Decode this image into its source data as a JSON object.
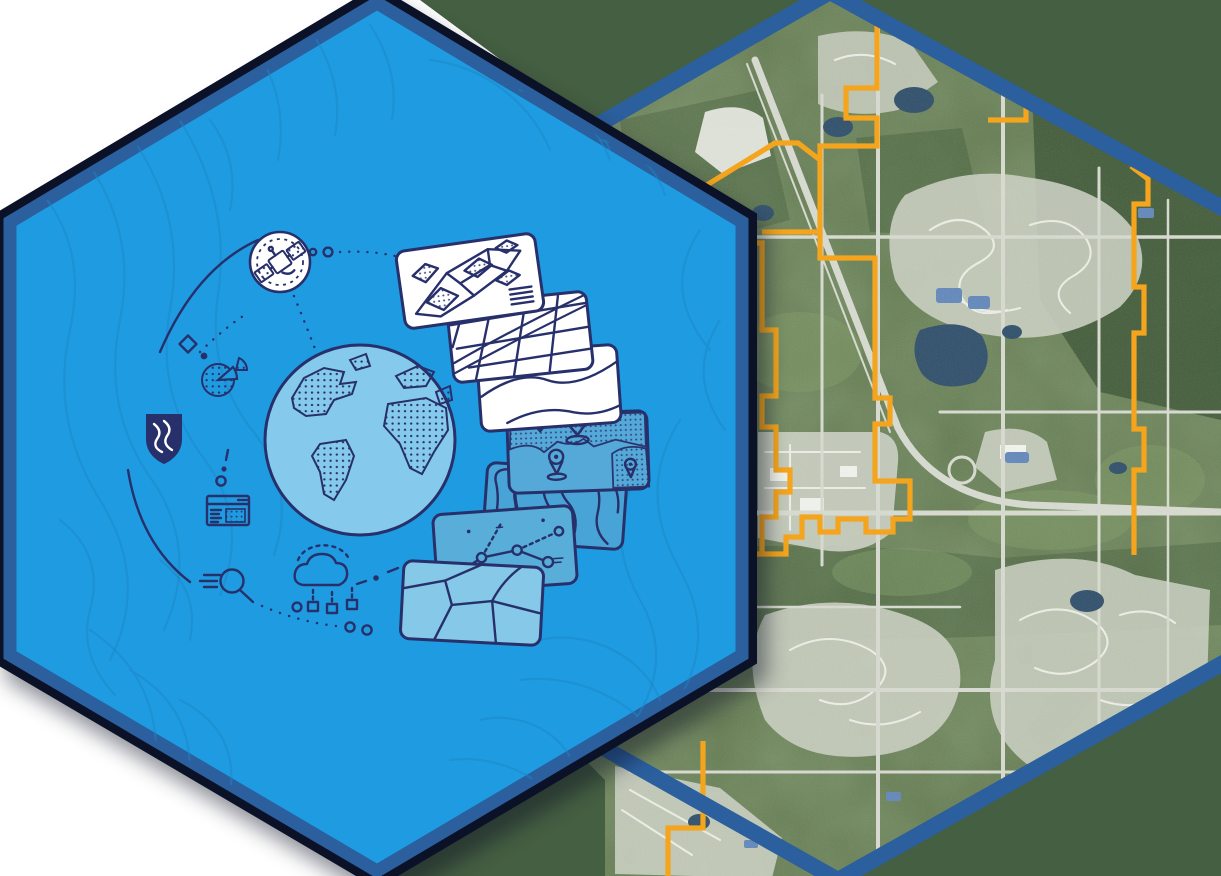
{
  "scene": {
    "left_hexagon": {
      "kind": "gis-illustration-hexagon",
      "icons": [
        "satellite-icon",
        "orbit-diamond-icon",
        "pie-chart-icon",
        "shield-logo-icon",
        "browser-window-icon",
        "search-icon",
        "cloud-download-icon",
        "globe-icon"
      ],
      "map_layer_cards": [
        "parcels-layer-card",
        "streets-layer-card",
        "terrain-layer-card",
        "poi-pins-layer-card",
        "contours-layer-card",
        "network-layer-card",
        "zones-layer-card"
      ]
    },
    "right_hexagon": {
      "kind": "aerial-imagery-hexagon",
      "overlay": "municipal-boundary-line"
    }
  },
  "palette": {
    "hex_fill": "#1f9ce1",
    "hex_contour": "#1b86c6",
    "border_blue": "#2b5f9d",
    "outline_dark": "#0b1126",
    "navy": "#27306b",
    "globe_fill": "#85caec",
    "card_blue": "#55a9d8",
    "card_blue2": "#48a4d6",
    "card_blue3": "#58aed9",
    "card_light": "#85c8e8",
    "green_flat": "#455f42",
    "green_base": "#62794f",
    "green_dark": "#3a5433",
    "green_light": "#7e9a64",
    "residential": "#cbd0c2",
    "road": "#d9dcd1",
    "lake": "#2f4f6b",
    "pool": "#6288bb",
    "orange": "#f4a51d",
    "white": "#ffffff"
  }
}
